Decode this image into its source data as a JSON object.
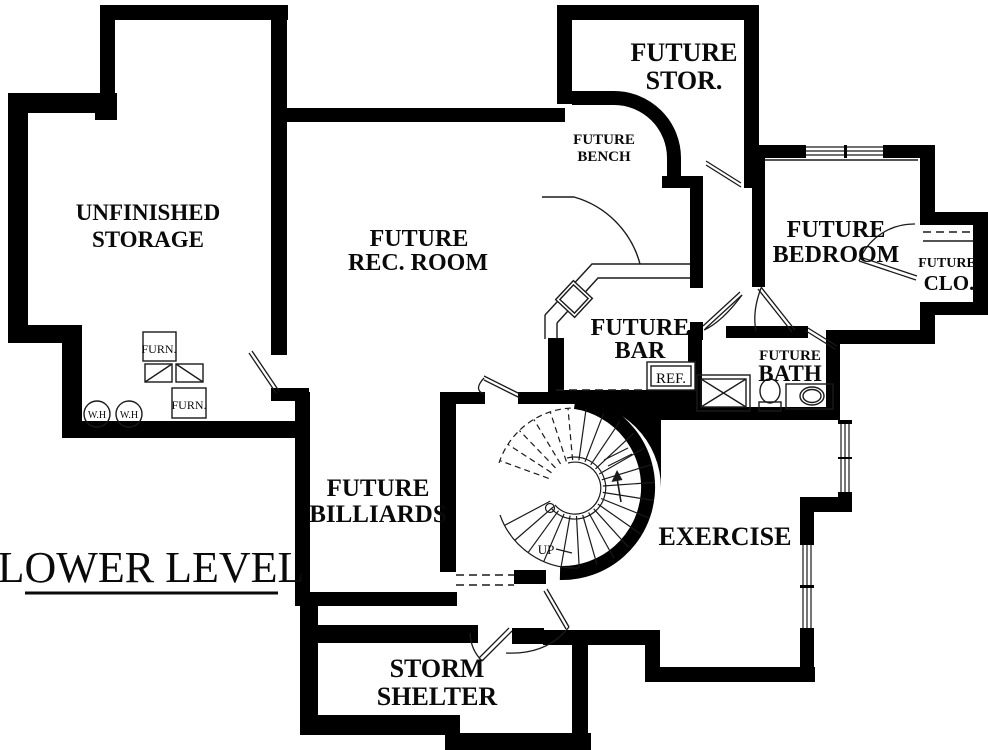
{
  "title": "LOWER LEVEL",
  "rooms": {
    "storage": {
      "line1": "UNFINISHED",
      "line2": "STORAGE"
    },
    "rec": {
      "line1": "FUTURE",
      "line2": "REC. ROOM"
    },
    "stor": {
      "line1": "FUTURE",
      "line2": "STOR."
    },
    "bench": {
      "line1": "FUTURE",
      "line2": "BENCH"
    },
    "bedroom": {
      "line1": "FUTURE",
      "line2": "BEDROOM"
    },
    "closet": {
      "line1": "FUTURE",
      "line2": "CLO."
    },
    "bar": {
      "line1": "FUTURE",
      "line2": "BAR"
    },
    "bath": {
      "line1": "FUTURE",
      "line2": "BATH"
    },
    "billiards": {
      "line1": "FUTURE",
      "line2": "BILLIARDS"
    },
    "exercise": {
      "line1": "EXERCISE"
    },
    "shelter": {
      "line1": "STORM",
      "line2": "SHELTER"
    }
  },
  "annotations": {
    "up": "UP",
    "ref": "REF.",
    "wh": "W.H",
    "furn": "FURN."
  },
  "colors": {
    "wall": "#000000",
    "background": "#ffffff",
    "line": "#1a1a1a"
  }
}
